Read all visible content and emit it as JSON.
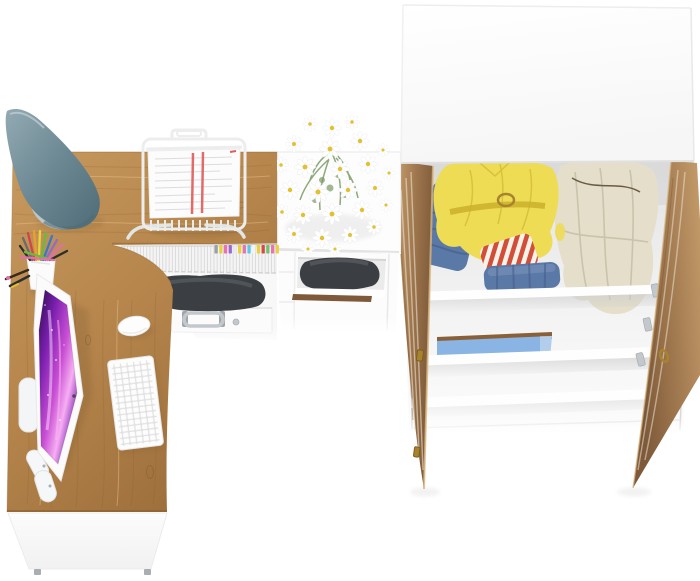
{
  "scene": {
    "description": "Top-down render of a home office set: L-shaped oak desk with monitor, keyboard, mouse, lamp, pen cup and document tray; white cabinet with daisy bouquet and printer shelf; open two-door oak wardrobe with clothes inside",
    "background": "#ffffff"
  },
  "objects": {
    "desk": "oak corner desk",
    "desk_lamp": "teal cone desk lamp",
    "pen_cup": "white pen cup with colored pens",
    "document_tray": "white wire document tray with papers",
    "monitor": "white monitor with purple galaxy wallpaper",
    "keyboard": "white keyboard",
    "mouse": "white mouse",
    "magazine_row": "magazines with colored index tabs",
    "dark_bag": "dark case with steel handle",
    "drawer": "white drawer with steel handle",
    "storage_cabinet": "white storage cabinet",
    "flowers": "white daisy bouquet",
    "printer": "black printer on cabinet shelf",
    "wardrobe": "white wardrobe with two open oak doors",
    "clothes": [
      "yellow jacket",
      "beige coat",
      "folded jeans",
      "red striped shirt",
      "blue storage box"
    ]
  },
  "palette": {
    "wood_light": "#c89a5e",
    "wood_mid": "#b5854c",
    "wood_dark": "#9b6d3a",
    "wood_edge": "#8a5f30",
    "door_light": "#c59c6a",
    "door_mid": "#9c744c",
    "door_dark": "#7e5a3a",
    "door_streak": "#ece2d2",
    "surface": "#fdfdfd",
    "surface_shade": "#f2f2f2",
    "edge": "#e4e4e4",
    "edge_dark": "#d8d8d8",
    "interior_top": "#e3e3e3",
    "interior_mid": "#f3f3f3",
    "interior_bottom": "#fcfcfc",
    "lamp_light": "#93aab3",
    "lamp_mid": "#6c8893",
    "lamp_dark": "#4e6c77",
    "lamp_base": "#b9c7cc",
    "lamp_arm": "#8e979b",
    "screen_dark": "#2b0b4e",
    "screen_purple": "#7a1fae",
    "screen_magenta": "#c94fd4",
    "screen_pink": "#f7aef3",
    "key_gap": "#e2e2e2",
    "key_face": "#fdfdfd",
    "printer_dark": "#3b3e42",
    "printer_mid": "#54585d",
    "silver": "#c3c8cc",
    "silver_dark": "#9fa6ab",
    "brass": "#a8832f",
    "brass_dark": "#7c5f1e",
    "jacket_yellow": "#eedc55",
    "jacket_dark": "#c9ae28",
    "coat_beige": "#e4deca",
    "coat_dark": "#b9b298",
    "denim": "#5b79a6",
    "denim_dark": "#45608b",
    "denim_light": "#7f98be",
    "stripe_red": "#d14f38",
    "stripe_cream": "#f7f2ea",
    "shelf_blue": "#8ab4e4",
    "shelf_blue_wood": "#8a6038",
    "daisy_white": "#ffffff",
    "daisy_center": "#e3c030",
    "stem_green": "#7a9a62",
    "paper": "#fcfcfc",
    "paper_line": "#dcdcdc",
    "paper_red": "#e25b5b",
    "wire": "#eceeee",
    "foot_gray": "#a9aeb2",
    "books_bg": "#f4f4f4",
    "books_line": "#d9d9d9"
  },
  "decorations": {
    "book_tabs": [
      "#9aa0a6",
      "#e8d040",
      "#e873b0",
      "#9a6ad0",
      "#ececec",
      "#e8d040",
      "#e873b0",
      "#5bc8e8",
      "#f4f4f4",
      "#e8d040",
      "#d84848",
      "#6cc46c",
      "#e873b0",
      "#e8d040"
    ],
    "daisies": [
      [
        332,
        128,
        1.0
      ],
      [
        310,
        124,
        0.8
      ],
      [
        352,
        122,
        0.8
      ],
      [
        294,
        144,
        0.9
      ],
      [
        330,
        149,
        1.1
      ],
      [
        360,
        141,
        1.0
      ],
      [
        383,
        150,
        0.7
      ],
      [
        281,
        165,
        0.8
      ],
      [
        305,
        167,
        1.1
      ],
      [
        340,
        169,
        1.0
      ],
      [
        368,
        164,
        1.0
      ],
      [
        389,
        173,
        0.7
      ],
      [
        290,
        190,
        1.0
      ],
      [
        318,
        192,
        1.15
      ],
      [
        348,
        190,
        1.0
      ],
      [
        375,
        188,
        0.9
      ],
      [
        282,
        212,
        0.8
      ],
      [
        303,
        215,
        1.0
      ],
      [
        332,
        214,
        1.1
      ],
      [
        362,
        210,
        1.0
      ],
      [
        386,
        205,
        0.7
      ],
      [
        294,
        234,
        0.9
      ],
      [
        322,
        238,
        1.0
      ],
      [
        350,
        235,
        0.9
      ],
      [
        374,
        227,
        0.8
      ],
      [
        335,
        249,
        0.7
      ],
      [
        308,
        249,
        0.7
      ]
    ],
    "pens": [
      [
        20,
        246,
        "#2e2e2e"
      ],
      [
        23,
        238,
        "#6b6b6b"
      ],
      [
        28,
        233,
        "#d04545"
      ],
      [
        34,
        231,
        "#e8a030"
      ],
      [
        40,
        231,
        "#e8d43e"
      ],
      [
        46,
        233,
        "#6db83e"
      ],
      [
        52,
        236,
        "#3878c8"
      ],
      [
        57,
        240,
        "#9868c8"
      ],
      [
        62,
        245,
        "#e070a8"
      ],
      [
        67,
        251,
        "#2e2e2e"
      ],
      [
        25,
        252,
        "#6db83e"
      ],
      [
        21,
        257,
        "#e070a8"
      ]
    ]
  }
}
